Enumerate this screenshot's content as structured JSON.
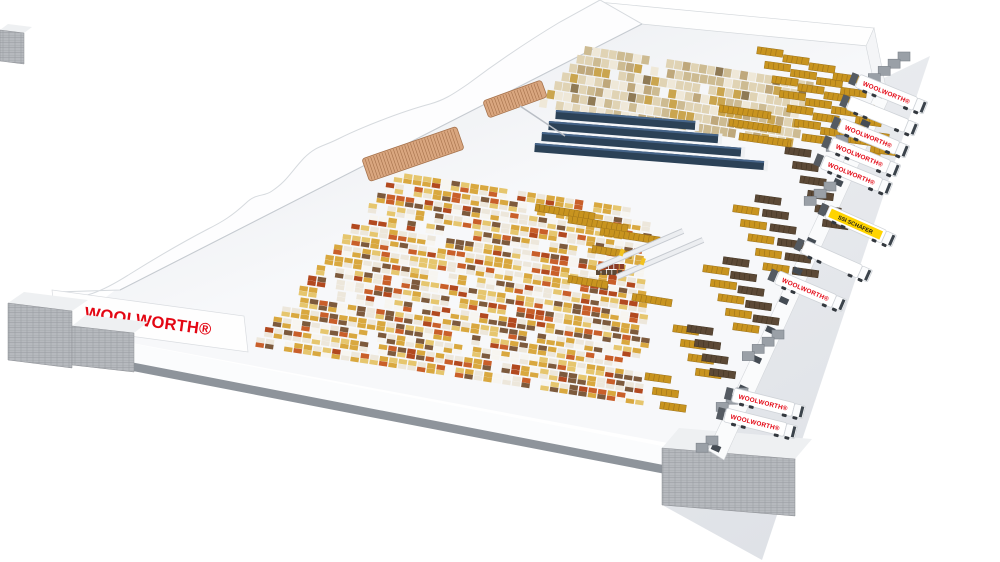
{
  "building": {
    "wall_logo": "WOOLWORTH®"
  },
  "trucks": [
    {
      "label": "WOOLWORTH®",
      "brand": "woolworth"
    },
    {
      "label": "",
      "brand": "plain"
    },
    {
      "label": "WOOLWORTH®",
      "brand": "woolworth"
    },
    {
      "label": "WOOLWORTH®",
      "brand": "woolworth"
    },
    {
      "label": "WOOLWORTH®",
      "brand": "woolworth"
    },
    {
      "label": "SSI SCHÄFER",
      "brand": "schaefer"
    },
    {
      "label": "",
      "brand": "plain"
    },
    {
      "label": "WOOLWORTH®",
      "brand": "woolworth"
    },
    {
      "label": "WOOLWORTH®",
      "brand": "woolworth"
    },
    {
      "label": "WOOLWORTH®",
      "brand": "woolworth"
    }
  ],
  "colors": {
    "brand_red": "#e30613",
    "schaefer_yellow": "#ffd400",
    "schaefer_text": "#1a1a1a",
    "navy_rack": "#2c4257",
    "navy_rack_top": "#46658a",
    "gold_pallet": "#c8941f",
    "gold_stripe": "#9c7118",
    "brown_pallet": "#5c4936",
    "brown_stripe": "#433523",
    "copper_rack": "#d9a67f",
    "copper_line": "#a5714b",
    "floor_dark": "#dde1e6",
    "floor_light": "#f7f8fa",
    "apron": "#e4e6ea",
    "annex_gray": "#b6b9be",
    "annex_line": "#989ca1",
    "wall_white": "#fdfdfe",
    "wall_edge": "#d6dade",
    "dock_door": "#454c54",
    "shelter_gray": "#555b62",
    "rack_palette": [
      "#ede7db",
      "#d9a83f",
      "#e6c66e",
      "#c95f2a",
      "#b2491f",
      "#7d5a3c",
      "#f7f5f0"
    ],
    "upper_palette": [
      "#e0d3b4",
      "#cdbb92",
      "#efe8d8",
      "#bfa87c",
      "#caa54f",
      "#8f7a55"
    ]
  }
}
